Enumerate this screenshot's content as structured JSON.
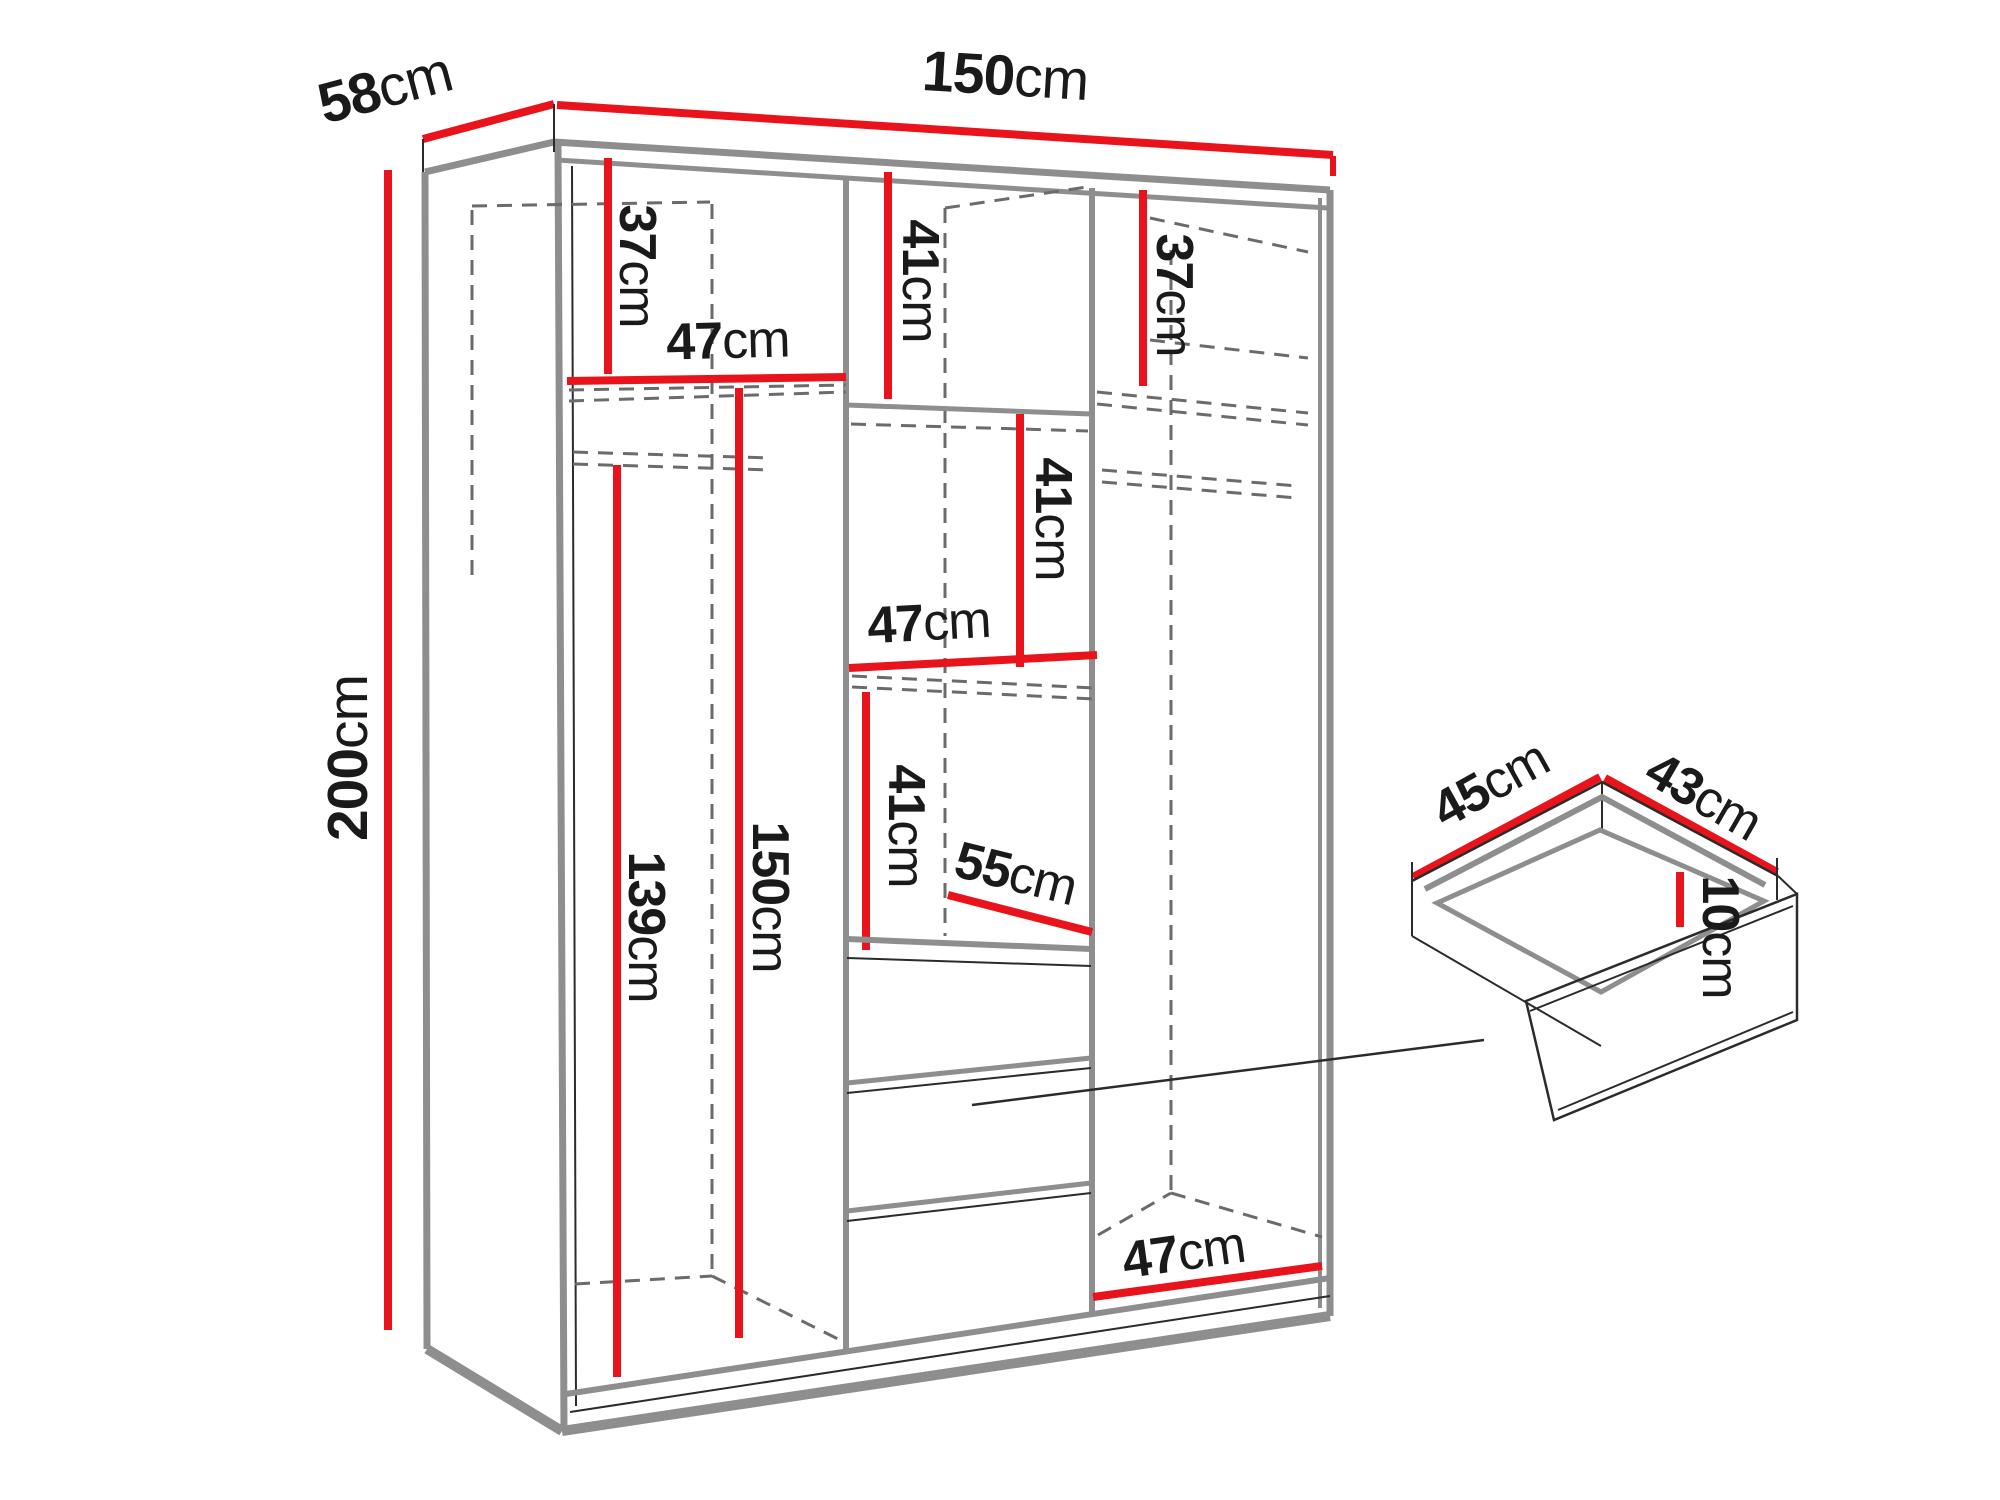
{
  "diagram": {
    "kind": "furniture-dimension-diagram",
    "subject": "three-section wardrobe interior layout with separate drawer detail",
    "units": "cm",
    "colors": {
      "dimension_line": "#e8131b",
      "edge_gray": "#8e8e8e",
      "hidden_edge": "#6b6b6b",
      "text": "#1a1a1a",
      "background": "#ffffff"
    },
    "wardrobe": {
      "width_cm": 150,
      "depth_cm": 58,
      "height_cm": 200
    },
    "drawer_detail": {
      "width_cm": 45,
      "depth_cm": 43,
      "height_cm": 10
    },
    "labels": {
      "depth_top": {
        "value": "58",
        "unit": "cm"
      },
      "width_top": {
        "value": "150",
        "unit": "cm"
      },
      "height_left": {
        "value": "200",
        "unit": "cm"
      },
      "left_top_section": {
        "value": "37",
        "unit": "cm"
      },
      "left_shelf_width": {
        "value": "47",
        "unit": "cm"
      },
      "mid_top_section": {
        "value": "41",
        "unit": "cm"
      },
      "right_top_section": {
        "value": "37",
        "unit": "cm"
      },
      "mid_second_section": {
        "value": "41",
        "unit": "cm"
      },
      "mid_shelf_width": {
        "value": "47",
        "unit": "cm"
      },
      "mid_third_section": {
        "value": "41",
        "unit": "cm"
      },
      "mid_compartment_depth": {
        "value": "55",
        "unit": "cm"
      },
      "left_hanging_height": {
        "value": "139",
        "unit": "cm"
      },
      "left_interior_height": {
        "value": "150",
        "unit": "cm"
      },
      "right_bottom_width": {
        "value": "47",
        "unit": "cm"
      },
      "drawer_width": {
        "value": "45",
        "unit": "cm"
      },
      "drawer_depth": {
        "value": "43",
        "unit": "cm"
      },
      "drawer_height": {
        "value": "10",
        "unit": "cm"
      }
    }
  }
}
